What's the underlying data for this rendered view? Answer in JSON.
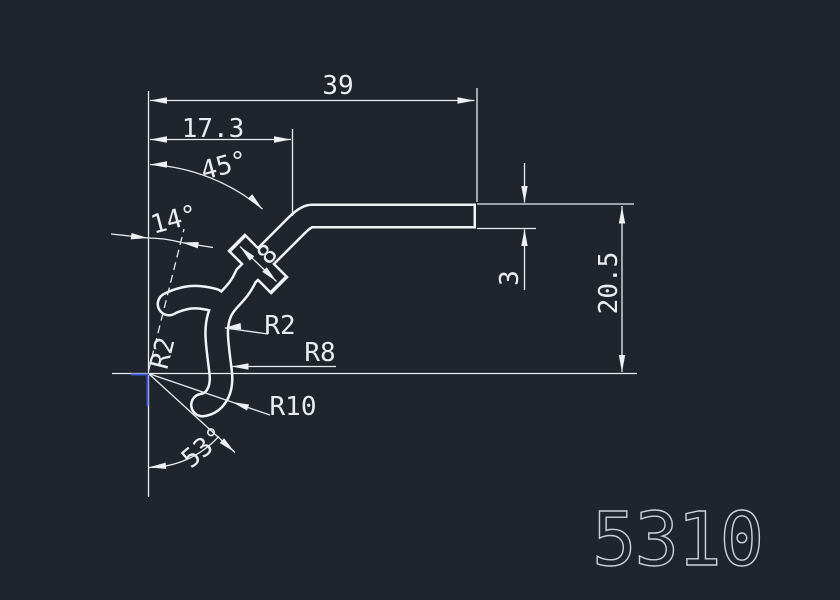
{
  "part_number": "5310",
  "colors": {
    "background": "#20242c",
    "dimension_lines": "#e9edf1",
    "profile_outline": "#f2f5f7",
    "part_number_text": "#ccd2d9",
    "crosshair_blue": "#3d57d9"
  },
  "dimensions": {
    "overall_width": "39",
    "upper_width": "17.3",
    "top_angle": "45°",
    "lip_angle": "14°",
    "bottom_angle": "53°",
    "tab_span": "8",
    "wall_thickness": "3",
    "overall_height": "20.5",
    "lip_radius": "R2",
    "bend_radius_inner": "R2",
    "bend_radius_mid": "R8",
    "bend_radius_outer": "R10"
  }
}
